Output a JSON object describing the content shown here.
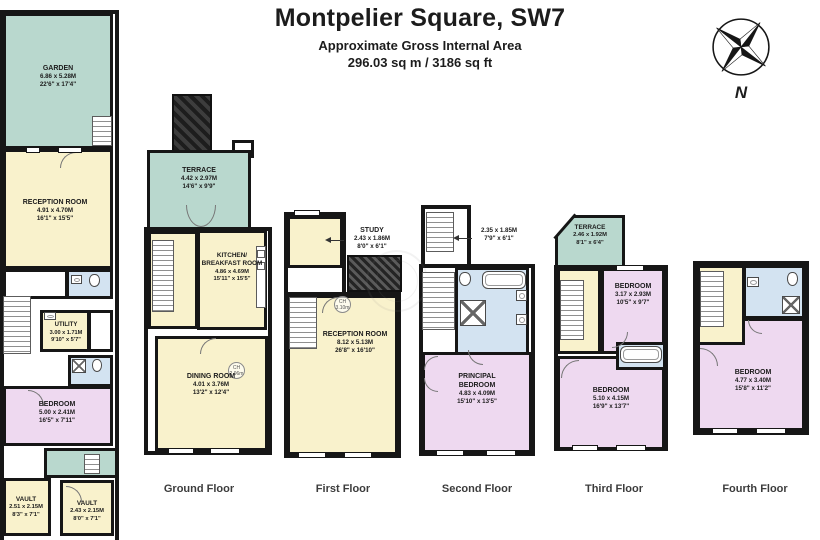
{
  "header": {
    "title": "Montpelier Square, SW7",
    "subtitle": "Approximate Gross Internal Area",
    "area": "296.03 sq m / 3186 sq ft"
  },
  "compass": {
    "north_label": "N"
  },
  "colors": {
    "wall": "#161616",
    "interior": "#f9f2cc",
    "outdoor": "#b9d8ce",
    "bedroom": "#eed9f0",
    "bathroom": "#d3e3f1"
  },
  "floor_labels": {
    "ground": "Ground Floor",
    "first": "First Floor",
    "second": "Second Floor",
    "third": "Third Floor",
    "fourth": "Fourth Floor"
  },
  "rooms": {
    "garden": {
      "name": "GARDEN",
      "metric": "6.86 x 5.28M",
      "imperial": "22'6\" x 17'4\""
    },
    "lg_reception": {
      "name": "RECEPTION ROOM",
      "metric": "4.91 x 4.70M",
      "imperial": "16'1\" x 15'5\""
    },
    "utility": {
      "name": "UTILITY",
      "metric": "3.00 x 1.71M",
      "imperial": "9'10\" x 5'7\""
    },
    "lg_bedroom": {
      "name": "BEDROOM",
      "metric": "5.00 x 2.41M",
      "imperial": "16'5\" x 7'11\""
    },
    "vault_left": {
      "name": "VAULT",
      "metric": "2.51 x 2.15M",
      "imperial": "8'3\" x 7'1\""
    },
    "vault_right": {
      "name": "VAULT",
      "metric": "2.43 x 2.15M",
      "imperial": "8'0\" x 7'1\""
    },
    "gf_terrace": {
      "name": "TERRACE",
      "metric": "4.42 x 2.97M",
      "imperial": "14'6\" x 9'9\""
    },
    "kitchen": {
      "name": "KITCHEN/ BREAKFAST ROOM",
      "metric": "4.86 x 4.69M",
      "imperial": "15'11\" x 15'5\""
    },
    "dining": {
      "name": "DINING ROOM",
      "metric": "4.01 x 3.76M",
      "imperial": "13'2\" x 12'4\""
    },
    "study": {
      "name": "STUDY",
      "metric": "2.43 x 1.86M",
      "imperial": "8'0\" x 6'1\""
    },
    "ff_reception": {
      "name": "RECEPTION ROOM",
      "metric": "8.12 x 5.13M",
      "imperial": "26'8\" x 16'10\""
    },
    "sf_landing": {
      "metric": "2.35 x 1.85M",
      "imperial": "7'9\" x 6'1\""
    },
    "principal_bedroom": {
      "name": "PRINCIPAL BEDROOM",
      "metric": "4.83 x 4.09M",
      "imperial": "15'10\" x 13'5\""
    },
    "tf_terrace": {
      "name": "TERRACE",
      "metric": "2.46 x 1.92M",
      "imperial": "8'1\" x 6'4\""
    },
    "tf_bedroom_front": {
      "name": "BEDROOM",
      "metric": "3.17 x 2.93M",
      "imperial": "10'5\" x 9'7\""
    },
    "tf_bedroom_back": {
      "name": "BEDROOM",
      "metric": "5.10 x 4.15M",
      "imperial": "16'9\" x 13'7\""
    },
    "fourth_bedroom": {
      "name": "BEDROOM",
      "metric": "4.77 x 3.40M",
      "imperial": "15'8\" x 11'2\""
    }
  },
  "ceiling_heights": {
    "dining": {
      "abbr": "CH",
      "value": "2.96m"
    },
    "reception": {
      "abbr": "CH",
      "value": "3.10m"
    }
  }
}
